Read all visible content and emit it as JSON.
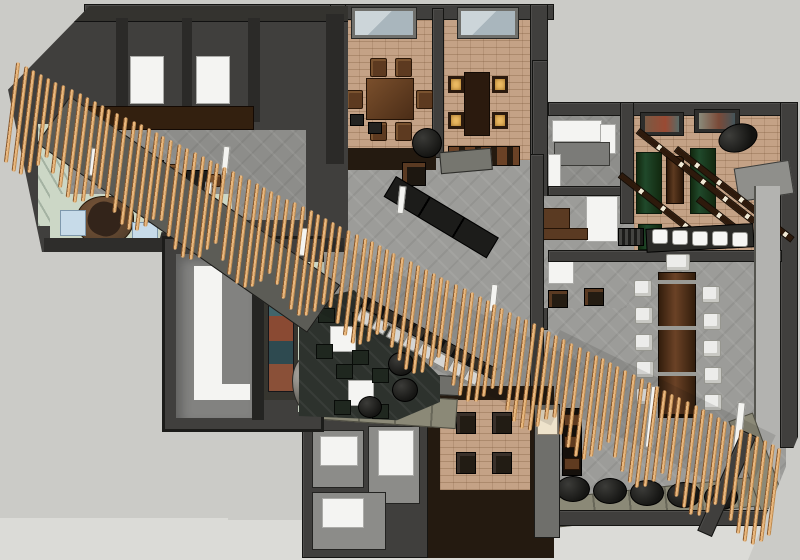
{
  "scene": {
    "kind": "3d-overhead-floor-plan-render",
    "subject": "restaurant-interior-with-diagonal-wood-slat-roof-screen"
  },
  "palette": {
    "bg": "#cbcbc7",
    "bg_light": "#dbdbd7",
    "wall": "#403f3d",
    "wall_edge": "#151513",
    "wall_mid": "#6b6a66",
    "tile": "#9c9c99",
    "brick": "#c4a286",
    "espresso": "#241a10",
    "charcoal": "#2d322d",
    "mint": "#ccd7c6",
    "slat": "#e8b77e",
    "slat_edge": "#8a5a2e",
    "walnut": "#4b2d17",
    "walnut_light": "#6b4226",
    "wood_mid": "#5d3a20",
    "green": "#20492b",
    "amber": "#ecba63",
    "olive": "#8b8977",
    "blue": "#c7dbe9",
    "white": "#f4f4f2",
    "canopy": "#5c5c56",
    "art_teal": "#41656b",
    "art_rust": "#8a4a33",
    "black": "#1b1b19",
    "cream": "#eee3cb",
    "corridor": "#b3b3b0",
    "glass": "#b9c4ca"
  },
  "counts": {
    "roof_slats": 100,
    "communal_side_chairs": 5,
    "communal_end_chairs": 1,
    "bar_stools": 5,
    "counter_seats": 8,
    "floor_poufs": 5,
    "dining_chairs_room_a": 6,
    "lit_chairs_room_b": 4,
    "booth_chairs": 4,
    "lounge_stool_chairs": 8,
    "lounge_tables": 2,
    "game_tables": 4,
    "light_beams": 4,
    "skylights": 2,
    "restroom_rooms": 3,
    "reception_seats": 2,
    "wall_pictures": 2,
    "kitchen_tables": 3
  },
  "regions": [
    "kitchen-wing",
    "reception",
    "gallery-room",
    "lounge",
    "dining-room-a",
    "dining-room-b",
    "main-hall",
    "pantry",
    "office",
    "game-room",
    "communal-dining",
    "booth-platform",
    "restrooms"
  ]
}
